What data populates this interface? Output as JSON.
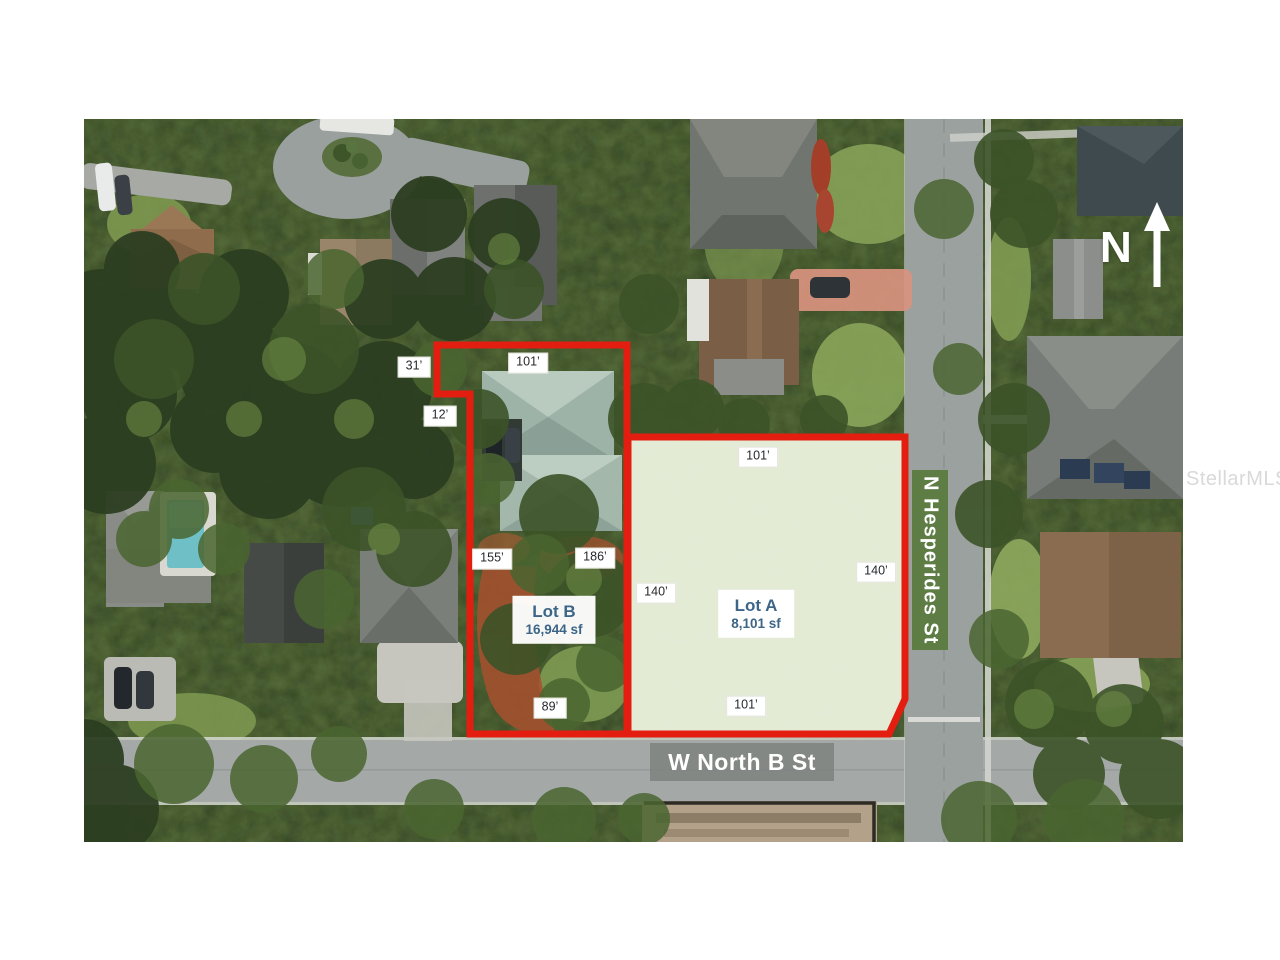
{
  "streets": {
    "horizontal": "W North B St",
    "vertical": "N Hesperides St"
  },
  "lots": {
    "lot_a": {
      "name": "Lot A",
      "area": "8,101 sf"
    },
    "lot_b": {
      "name": "Lot B",
      "area": "16,944 sf"
    }
  },
  "dimensions": {
    "lot_b_top_left": "31’",
    "lot_b_top": "101’",
    "lot_b_step": "12’",
    "lot_b_left": "155’",
    "lot_b_right": "186’",
    "lot_b_bottom": "89’",
    "lot_a_top": "101’",
    "lot_a_left": "140’",
    "lot_a_right": "140’",
    "lot_a_bottom": "101’"
  },
  "north_indicator": {
    "label": "N"
  },
  "watermark": "StellarMLS",
  "colors": {
    "lot_outline_red": "#e31e10",
    "lot_a_fill": "#e8efdb",
    "street_banner_green": "#5d7d44",
    "street_banner_gray": "#7d807e",
    "lot_label_text": "#3c6588"
  }
}
